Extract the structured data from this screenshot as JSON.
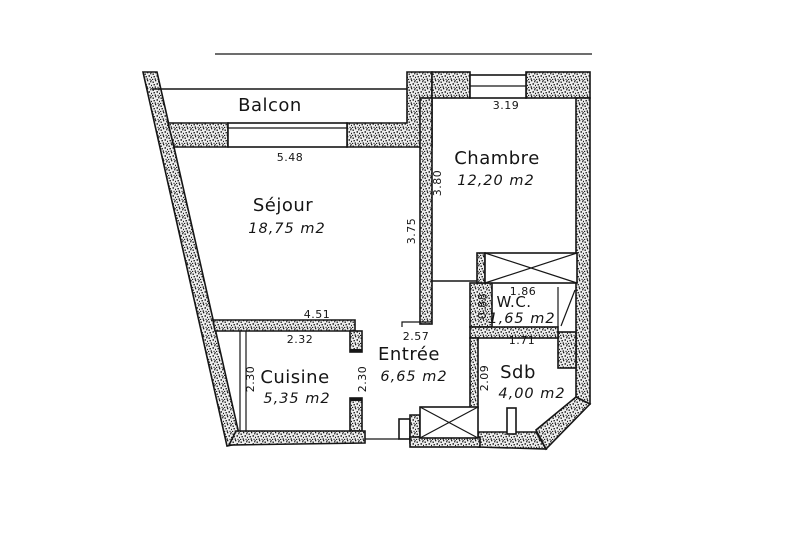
{
  "plan": {
    "rooms": {
      "balcon": {
        "name": "Balcon"
      },
      "sejour": {
        "name": "Séjour",
        "area": "18,75 m2"
      },
      "chambre": {
        "name": "Chambre",
        "area": "12,20 m2"
      },
      "cuisine": {
        "name": "Cuisine",
        "area": "5,35 m2"
      },
      "entree": {
        "name": "Entrée",
        "area": "6,65 m2"
      },
      "wc": {
        "name": "W.C.",
        "area": "1,65 m2"
      },
      "sdb": {
        "name": "Sdb",
        "area": "4,00 m2"
      }
    },
    "dimensions": {
      "sejour_top": "5.48",
      "sejour_right": "3.75",
      "sejour_bottom": "4.51",
      "chambre_top": "3.19",
      "chambre_left": "3.80",
      "cuisine_top": "2.32",
      "cuisine_left": "2.30",
      "cuisine_right": "2.30",
      "entree_top": "2.57",
      "wc_top": "1.86",
      "wc_left": "0.88",
      "sdb_top": "1.71",
      "sdb_left": "2.09"
    },
    "colors": {
      "line": "#161616",
      "background": "#ffffff"
    }
  }
}
